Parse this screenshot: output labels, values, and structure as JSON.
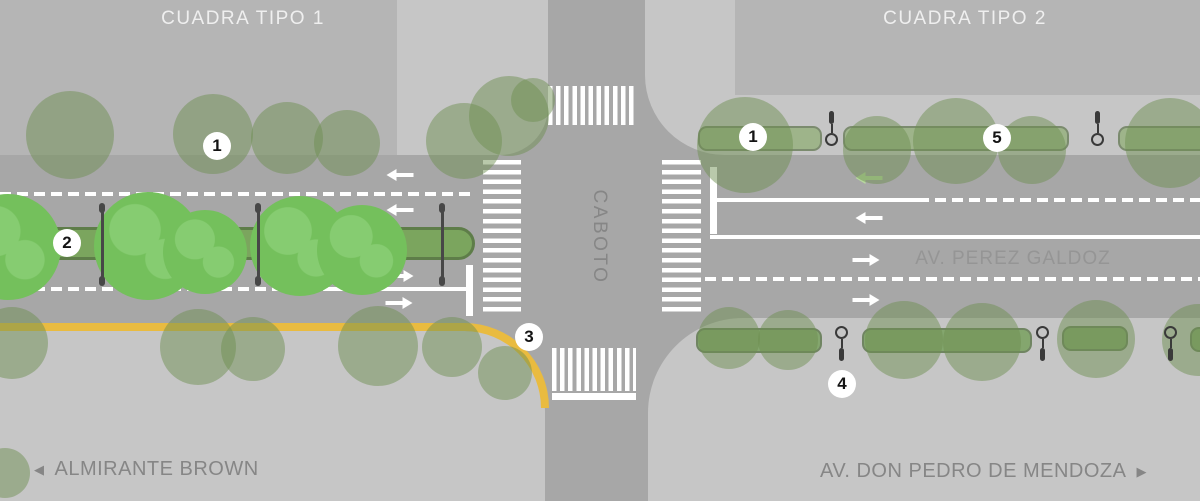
{
  "labels": {
    "left_block_title": "CUADRA TIPO 1",
    "right_block_title": "CUADRA TIPO 2",
    "cross_street": "CABOTO",
    "avenue_center": "AV. PEREZ GALDOZ",
    "bottom_left": {
      "direction_icon": "◀",
      "text": "ALMIRANTE BROWN"
    },
    "bottom_right": {
      "text": "AV. DON PEDRO DE MENDOZA",
      "direction_icon": "▶"
    }
  },
  "legend_badges": [
    {
      "n": "1",
      "x": 217,
      "y": 146
    },
    {
      "n": "2",
      "x": 67,
      "y": 243
    },
    {
      "n": "3",
      "x": 529,
      "y": 337
    },
    {
      "n": "1",
      "x": 753,
      "y": 137
    },
    {
      "n": "5",
      "x": 997,
      "y": 138
    },
    {
      "n": "4",
      "x": 842,
      "y": 384
    }
  ],
  "colors": {
    "road": "#a7a7a7",
    "sidewalk": "#c6c6c6",
    "block": "#b5b5b5",
    "curb_yellow": "#e9bb40",
    "tree_muted": "rgba(108,142,80,0.48)",
    "tree_bright": "#74c05c",
    "tree_bright_light": "#86cc71",
    "median_fill": "#7ba55e",
    "median_border": "#5e7d49",
    "planter_fill_top": "rgba(125,165,90,0.55)",
    "planter_fill_bottom": "rgba(110,155,80,0.75)",
    "planter_border": "rgba(95,105,88,0.55)",
    "stake": "#474747",
    "lamp": "#3a3a3a",
    "arrow_green": "#b7d89e",
    "arrow_white": "#ffffff",
    "label_white": "#efefef",
    "label_gray": "#868686",
    "label_road": "#959595"
  },
  "map": {
    "crosswalks": [
      {
        "x": 548,
        "y": 86,
        "w": 89,
        "h": 39,
        "dir": "v"
      },
      {
        "x": 483,
        "y": 160,
        "w": 38,
        "h": 156,
        "dir": "h"
      },
      {
        "x": 662,
        "y": 160,
        "w": 39,
        "h": 156,
        "dir": "h"
      },
      {
        "x": 552,
        "y": 348,
        "w": 84,
        "h": 43,
        "dir": "v"
      }
    ],
    "stop_bars": [
      {
        "x": 466,
        "y": 265,
        "w": 7,
        "h": 51
      },
      {
        "x": 710,
        "y": 167,
        "w": 7,
        "h": 67
      },
      {
        "x": 552,
        "y": 393,
        "w": 84,
        "h": 7
      }
    ],
    "lane_lines": [
      {
        "x": 0,
        "y": 192,
        "w": 471,
        "style": "dashed"
      },
      {
        "x": 0,
        "y": 287,
        "w": 330,
        "style": "dashed"
      },
      {
        "x": 325,
        "y": 287,
        "w": 142,
        "style": "solid"
      },
      {
        "x": 716,
        "y": 198,
        "w": 202,
        "style": "solid"
      },
      {
        "x": 918,
        "y": 198,
        "w": 282,
        "style": "dashed"
      },
      {
        "x": 710,
        "y": 235,
        "w": 490,
        "style": "solid"
      },
      {
        "x": 705,
        "y": 277,
        "w": 495,
        "style": "dashed"
      }
    ],
    "arrows": [
      {
        "x": 400,
        "y": 175,
        "dir": "left",
        "c": "white"
      },
      {
        "x": 400,
        "y": 210,
        "dir": "left",
        "c": "white"
      },
      {
        "x": 400,
        "y": 276,
        "dir": "right",
        "c": "white"
      },
      {
        "x": 399,
        "y": 303,
        "dir": "right",
        "c": "white"
      },
      {
        "x": 869,
        "y": 178,
        "dir": "left",
        "c": "green"
      },
      {
        "x": 869,
        "y": 218,
        "dir": "left",
        "c": "white"
      },
      {
        "x": 866,
        "y": 260,
        "dir": "right",
        "c": "white"
      },
      {
        "x": 866,
        "y": 300,
        "dir": "right",
        "c": "white"
      }
    ],
    "median": {
      "x": -30,
      "y": 227,
      "w": 505,
      "h": 33,
      "stakes": [
        102,
        258,
        442
      ]
    },
    "trees_bright": [
      [
        8,
        247,
        53
      ],
      [
        148,
        246,
        54
      ],
      [
        205,
        252,
        42
      ],
      [
        300,
        246,
        50
      ],
      [
        362,
        250,
        45
      ]
    ],
    "trees_muted": [
      [
        70,
        135,
        44
      ],
      [
        213,
        134,
        40
      ],
      [
        287,
        138,
        36
      ],
      [
        347,
        143,
        33
      ],
      [
        464,
        141,
        38
      ],
      [
        509,
        116,
        40
      ],
      [
        533,
        100,
        22
      ],
      [
        12,
        343,
        36
      ],
      [
        198,
        347,
        38
      ],
      [
        253,
        349,
        32
      ],
      [
        378,
        346,
        40
      ],
      [
        452,
        347,
        30
      ],
      [
        505,
        373,
        27
      ],
      [
        5,
        473,
        25
      ],
      [
        745,
        145,
        48
      ],
      [
        877,
        150,
        34
      ],
      [
        956,
        141,
        43
      ],
      [
        1032,
        150,
        34
      ],
      [
        1170,
        143,
        45
      ],
      [
        729,
        338,
        31
      ],
      [
        788,
        340,
        30
      ],
      [
        904,
        340,
        39
      ],
      [
        982,
        342,
        39
      ],
      [
        1096,
        339,
        39
      ],
      [
        1198,
        340,
        36
      ]
    ],
    "planters_top": [
      [
        698,
        126,
        124,
        25
      ],
      [
        843,
        126,
        226,
        25
      ],
      [
        1118,
        126,
        92,
        25
      ]
    ],
    "planters_bottom": [
      [
        696,
        328,
        126,
        25
      ],
      [
        862,
        328,
        170,
        25
      ],
      [
        1062,
        326,
        66,
        25
      ],
      [
        1190,
        327,
        60,
        25
      ]
    ],
    "lamps_top": [
      831,
      1097
    ],
    "lamps_bottom": [
      841,
      1042,
      1170
    ]
  }
}
